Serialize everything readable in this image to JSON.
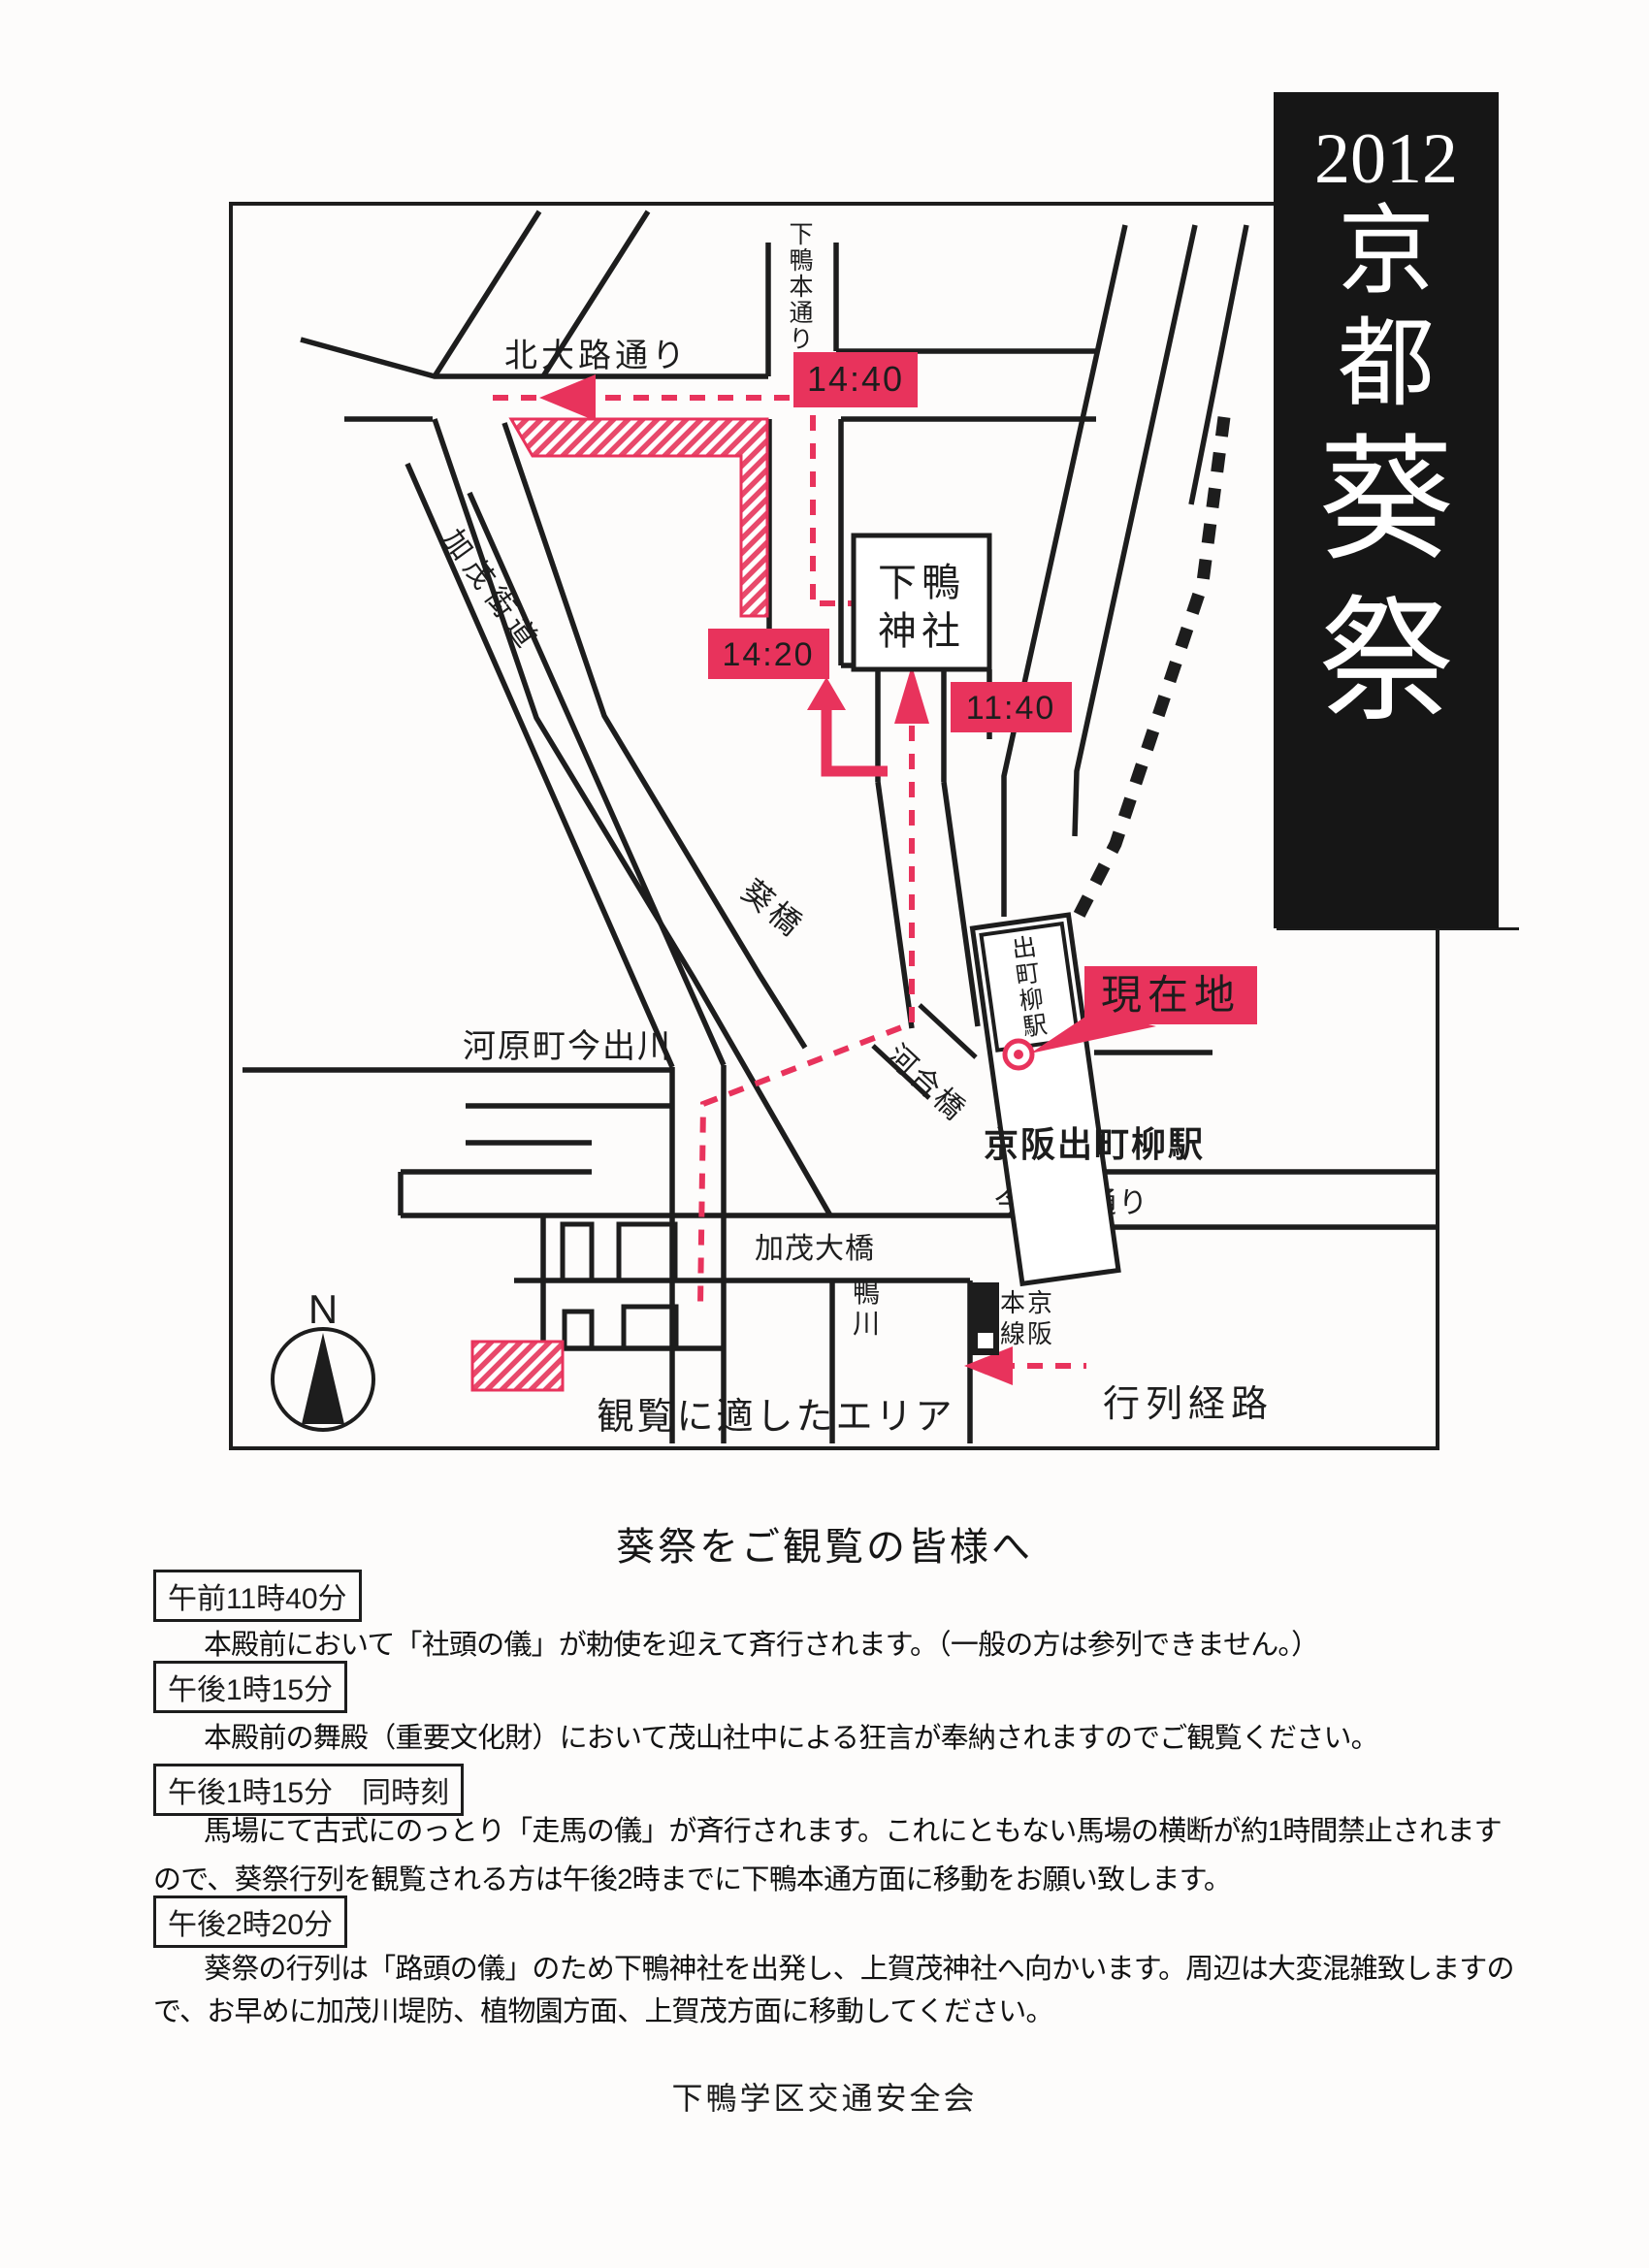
{
  "banner": {
    "year": "2012",
    "title_chars": "京都葵祭",
    "bg": "#161616",
    "fg": "#ffffff"
  },
  "map": {
    "ink": "#1d1d1d",
    "accent": "#e8335c",
    "compass": {
      "label": "N"
    },
    "streets": {
      "kitaoji": "北大路通り",
      "shimogamo_hondori": "下鴨本通り",
      "kamo_kaido": "加茂街道",
      "aoibashi": "葵橋",
      "kawaramachi_imadegawa": "河原町今出川",
      "kawaibashi": "河合橋",
      "imadegawa_dori": "今出川通り",
      "kamo_ohashi": "加茂大橋",
      "kamogawa": "鴨川"
    },
    "places": {
      "shimogamo_line1": "下鴨",
      "shimogamo_line2": "神社",
      "demachiyanagi_station": "出町柳駅",
      "keihan_demachiyanagi": "京阪出町柳駅",
      "keihan_honsen": "京阪本線",
      "genzaichi": "現在地"
    },
    "times": {
      "arrive": "11:40",
      "depart": "14:20",
      "kitaoji_pass": "14:40"
    },
    "legend": {
      "route": "行列経路",
      "viewing_area": "観覧に適したエリア"
    }
  },
  "notice": {
    "heading": "葵祭をご観覧の皆様へ",
    "items": [
      {
        "time": "午前11時40分",
        "lines": [
          "本殿前において「社頭の儀」が勅使を迎えて斉行されます。（一般の方は参列できません。）"
        ]
      },
      {
        "time": "午後1時15分",
        "lines": [
          "本殿前の舞殿（重要文化財）において茂山社中による狂言が奉納されますのでご観覧ください。"
        ]
      },
      {
        "time": "午後1時15分　同時刻",
        "lines": [
          "馬場にて古式にのっとり「走馬の儀」が斉行されます。これにともない馬場の横断が約1時間禁止されます",
          "ので、葵祭行列を観覧される方は午後2時までに下鴨本通方面に移動をお願い致します。"
        ]
      },
      {
        "time": "午後2時20分",
        "lines": [
          "葵祭の行列は「路頭の儀」のため下鴨神社を出発し、上賀茂神社へ向かいます。周辺は大変混雑致しますの",
          "で、お早めに加茂川堤防、植物園方面、上賀茂方面に移動してください。"
        ]
      }
    ],
    "footer": "下鴨学区交通安全会"
  }
}
